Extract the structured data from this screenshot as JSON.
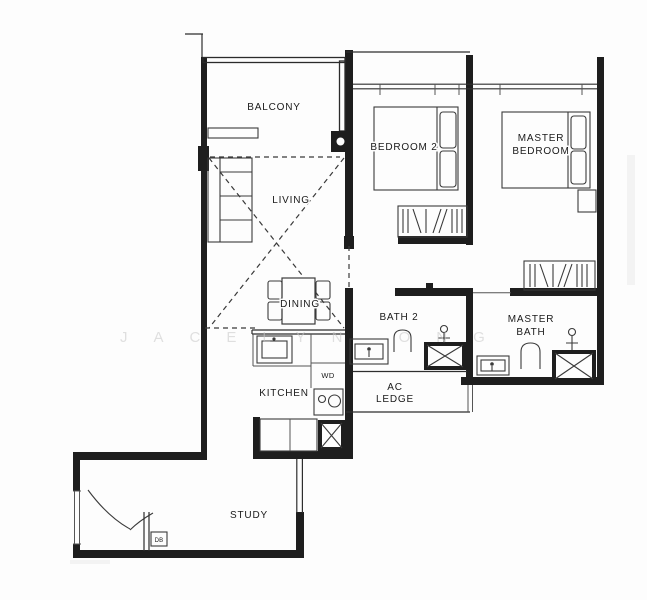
{
  "page": {
    "background": "#fdfdfd"
  },
  "floorplan": {
    "watermark": "JACELYN ONG",
    "colors": {
      "wall": "#1e1e1e",
      "line": "#2e2e2e",
      "text": "#1a1a1a",
      "watermark": "#c8c8c8",
      "background": "#fdfdfd"
    },
    "rooms": {
      "balcony": "BALCONY",
      "living": "LIVING",
      "dining": "DINING",
      "bedroom2": "BEDROOM 2",
      "master_bedroom": {
        "line1": "MASTER",
        "line2": "BEDROOM"
      },
      "bath2": "BATH 2",
      "master_bath": {
        "line1": "MASTER",
        "line2": "BATH"
      },
      "ac_ledge": {
        "line1": "AC",
        "line2": "LEDGE"
      },
      "kitchen": "KITCHEN",
      "wd": "WD",
      "study": "STUDY",
      "db": "DB"
    }
  }
}
